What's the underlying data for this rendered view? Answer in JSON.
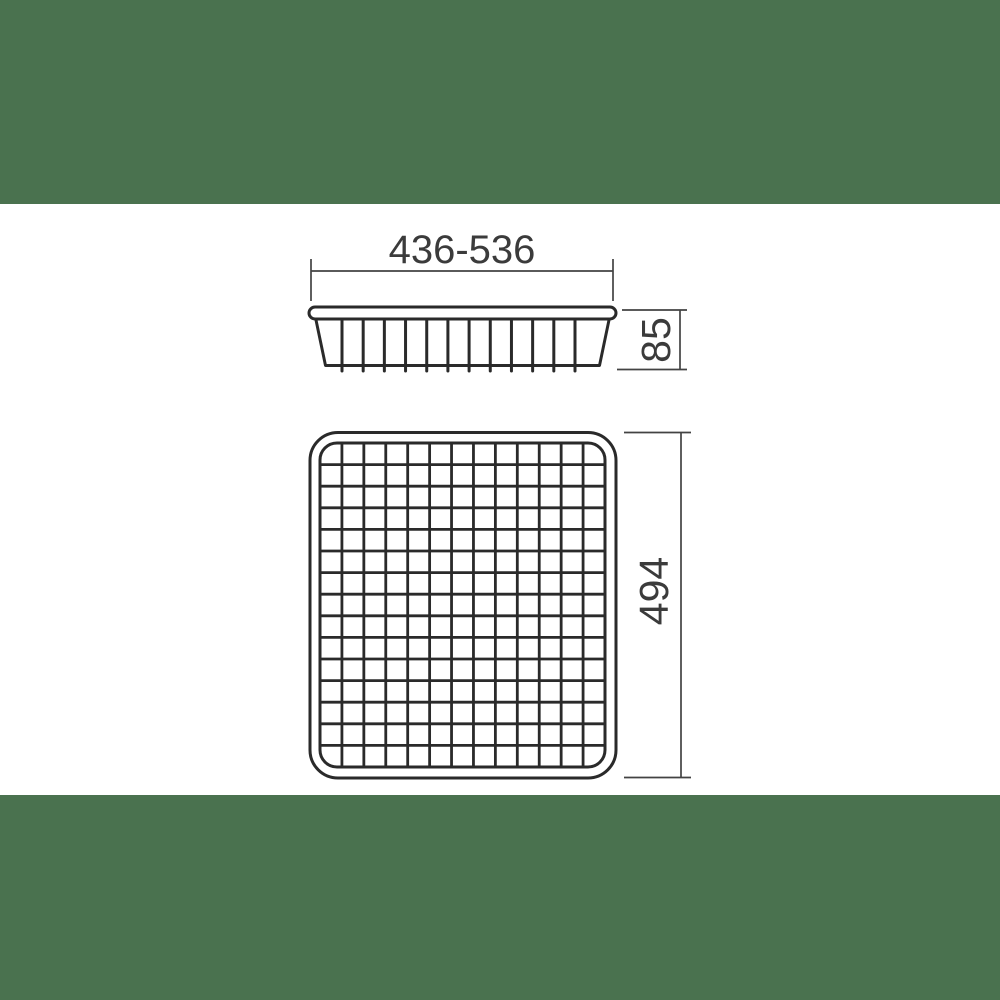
{
  "page": {
    "background_color": "#ffffff",
    "band_color": "#4a724f"
  },
  "drawing": {
    "subject": "wire-mesh-basket-technical-drawing",
    "line_color": "#2a2a2a",
    "dimension_line_color": "#434343",
    "dimension_text_color": "#3b3b3b",
    "side_view": {
      "wire_count": 12
    },
    "top_view": {
      "grid_columns": 13,
      "grid_rows": 15
    },
    "dimensions": {
      "width_range": {
        "label": "436-536"
      },
      "height": {
        "label": "85"
      },
      "depth": {
        "label": "494"
      }
    }
  }
}
